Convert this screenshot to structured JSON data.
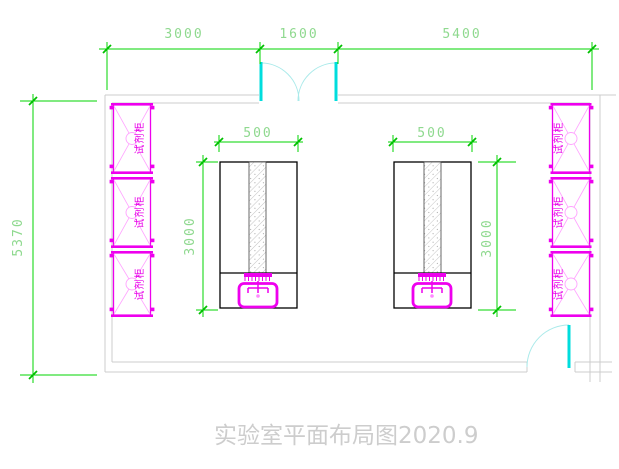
{
  "title": {
    "text": "实验室平面布局图2020.9"
  },
  "dimensions": {
    "top": [
      {
        "label": "3000"
      },
      {
        "label": "1600"
      },
      {
        "label": "5400"
      }
    ],
    "overall_height": {
      "label": "5370"
    },
    "bench_left": {
      "width": {
        "label": "500"
      },
      "depth": {
        "label": "3000"
      }
    },
    "bench_right": {
      "width": {
        "label": "500"
      },
      "depth": {
        "label": "3000"
      }
    }
  },
  "cabinets": {
    "left": [
      {
        "label": "试剂柜"
      },
      {
        "label": "试剂柜"
      },
      {
        "label": "试剂柜"
      }
    ],
    "right": [
      {
        "label": "试剂柜"
      },
      {
        "label": "试剂柜"
      },
      {
        "label": "试剂柜"
      }
    ]
  },
  "colors": {
    "dimension_line": "#00d400",
    "dimension_text": "#8fd98f",
    "wall": "#cccccc",
    "equipment_magenta": "#ee00ee",
    "equipment_pink": "#ffa3ff",
    "door_leaf": "#00dddd",
    "door_swing": "#aaeaea",
    "bench_outline": "#000000",
    "title_text": "#cdcdcd"
  }
}
